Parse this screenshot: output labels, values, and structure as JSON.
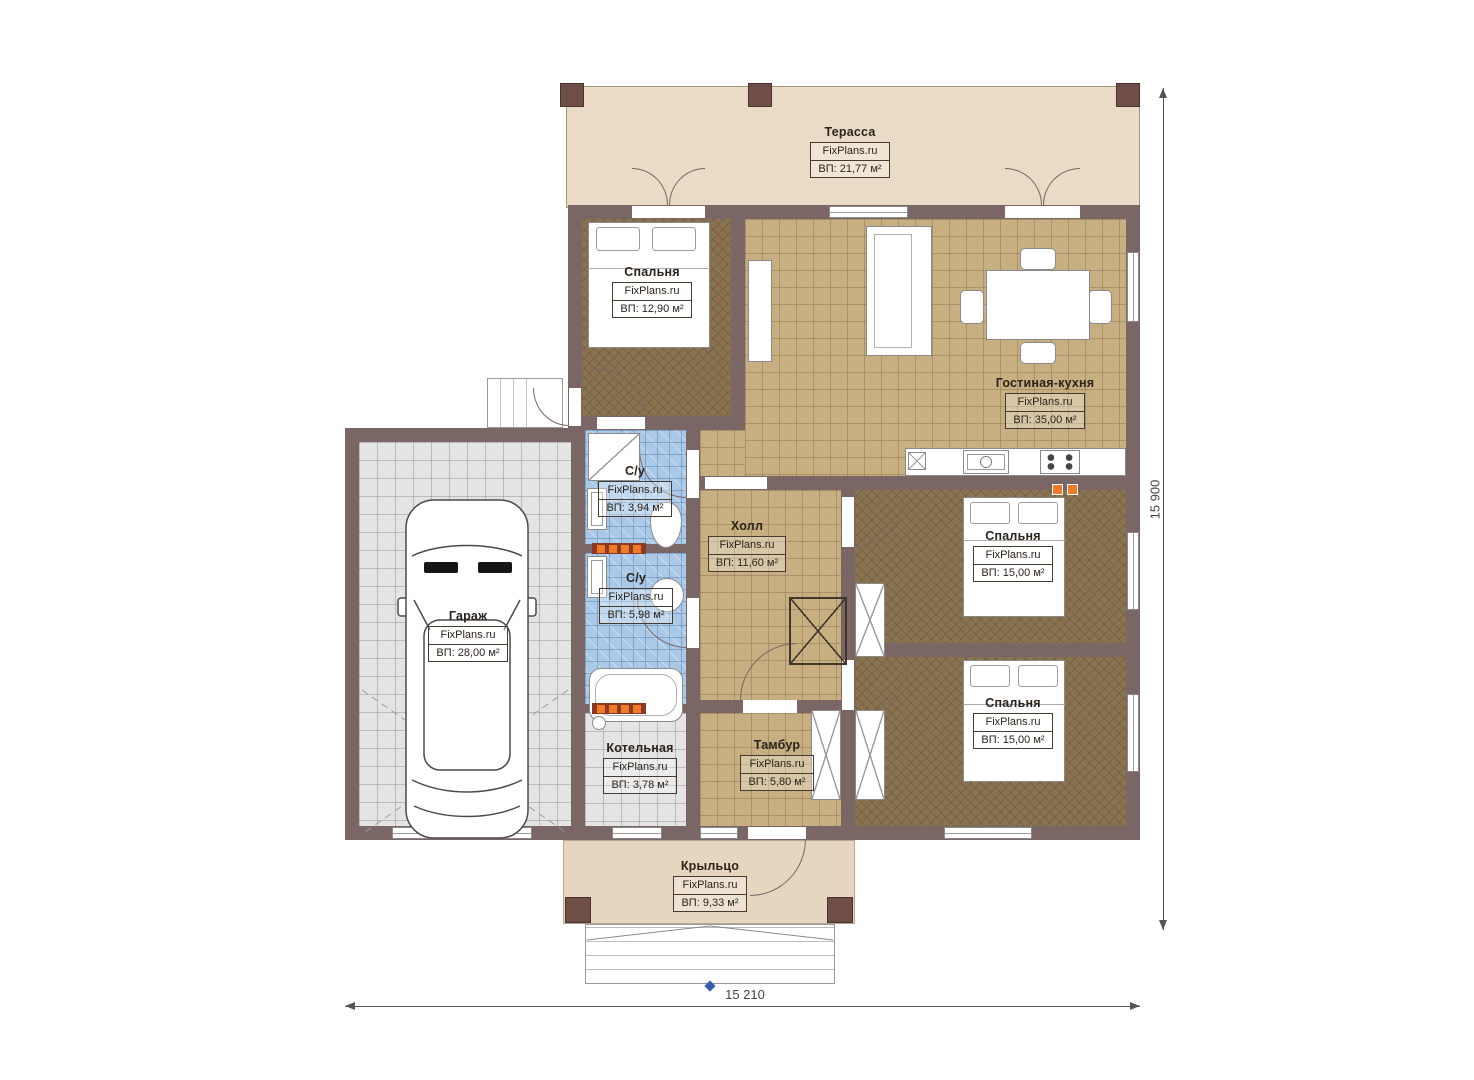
{
  "plan": {
    "watermark": "FixPlans.ru",
    "rooms": [
      {
        "id": "terrace",
        "name": "Терасса",
        "area": "ВП: 21,77 м²"
      },
      {
        "id": "bedroom-1",
        "name": "Спальня",
        "area": "ВП: 12,90 м²"
      },
      {
        "id": "living-kitchen",
        "name": "Гостиная-кухня",
        "area": "ВП: 35,00 м²"
      },
      {
        "id": "bathroom-1",
        "name": "С/у",
        "area": "ВП: 3,94 м²"
      },
      {
        "id": "bathroom-2",
        "name": "С/у",
        "area": "ВП: 5,98 м²"
      },
      {
        "id": "hall",
        "name": "Холл",
        "area": "ВП: 11,60 м²"
      },
      {
        "id": "bedroom-2",
        "name": "Спальня",
        "area": "ВП: 15,00 м²"
      },
      {
        "id": "garage",
        "name": "Гараж",
        "area": "ВП: 28,00 м²"
      },
      {
        "id": "bedroom-3",
        "name": "Спальня",
        "area": "ВП: 15,00 м²"
      },
      {
        "id": "boiler-room",
        "name": "Котельная",
        "area": "ВП: 3,78 м²"
      },
      {
        "id": "vestibule",
        "name": "Тамбур",
        "area": "ВП: 5,80 м²"
      },
      {
        "id": "porch",
        "name": "Крыльцо",
        "area": "ВП: 9,33 м²"
      }
    ],
    "dimensions": {
      "bottom": "15 210",
      "right": "15 900"
    },
    "colors": {
      "wall": "#7b6666",
      "terrace_floor": "#e9dbc5",
      "tile_tan": "#c7af82",
      "bedroom_floor": "#8a7350",
      "tile_blue": "#aac9e8",
      "tile_gray": "#e4e4e4",
      "porch_floor": "#e6d6bf",
      "heater_accent": "#f07a28",
      "entry_marker": "#3a5fb0"
    }
  }
}
